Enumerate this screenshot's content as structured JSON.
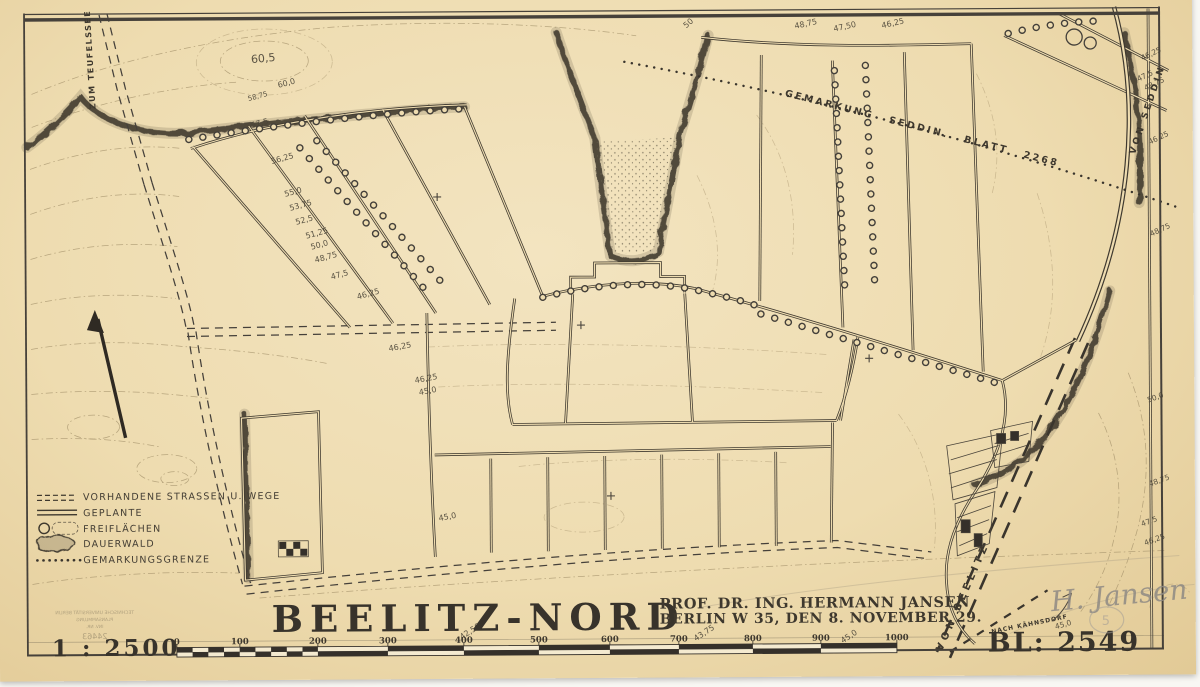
{
  "title_block": {
    "title": "BEELITZ-NORD",
    "author_line1": "PROF. DR. ING. HERMANN JANSEN",
    "author_line2": "BERLIN W 35, DEN 8. NOVEMBER 29.",
    "scale_label": "1 : 2500",
    "sheet_number": "BL: 2549"
  },
  "legend": {
    "items": [
      {
        "label": "VORHANDENE STRASSEN U. WEGE",
        "symbol": "double-dashed-line"
      },
      {
        "label": "GEPLANTE",
        "symbol": "double-solid-line"
      },
      {
        "label": "FREIFLÄCHEN",
        "symbol": "open-space"
      },
      {
        "label": "DAUERWALD",
        "symbol": "forest-blob"
      },
      {
        "label": "GEMARKUNGSGRENZE",
        "symbol": "dotted-line"
      }
    ]
  },
  "road_labels": {
    "zum_teufelssee": "ZUM TEUFELSSEE",
    "von_seddin": "VON SEDDIN",
    "von_beelitz": "VON BEELITZ",
    "nach_kaehnsdorf": "NACH KÄHNSDORF",
    "gemarkungsgrenze": "GEMARKUNG  SEDDIN.  BLATT 2268"
  },
  "scale_bar": {
    "unit_labels": [
      "0",
      "100",
      "200",
      "300",
      "400",
      "500",
      "600",
      "700",
      "800",
      "900",
      "1000"
    ]
  },
  "elevations": [
    "60,5",
    "60,0",
    "58,75",
    "57,5",
    "56,25",
    "55,0",
    "53,75",
    "52,5",
    "51,25",
    "50,0",
    "48,75",
    "47,5",
    "46,25",
    "46,25",
    "46,25",
    "45,0",
    "45,0",
    "50",
    "48,75",
    "47,50",
    "46,25",
    "46,25",
    "47,5",
    "48,75",
    "46,25",
    "48,75",
    "50,0",
    "48,75",
    "47,5",
    "46,25",
    "42,50",
    "43,75",
    "45,0",
    "45,0"
  ],
  "pencil": {
    "signature": "H. Jansen",
    "circled_note": "5"
  },
  "stamp": {
    "line1": "TECHNISCHE UNIVERSITÄT BERLIN",
    "line2": "PLANSAMMLUNG",
    "line3": "INV. NR.",
    "line4": "24463"
  },
  "colors": {
    "paper": "#eedcb0",
    "ink": "#3e382e",
    "contour": "#a18f68",
    "pencil": "#8f8a84"
  }
}
